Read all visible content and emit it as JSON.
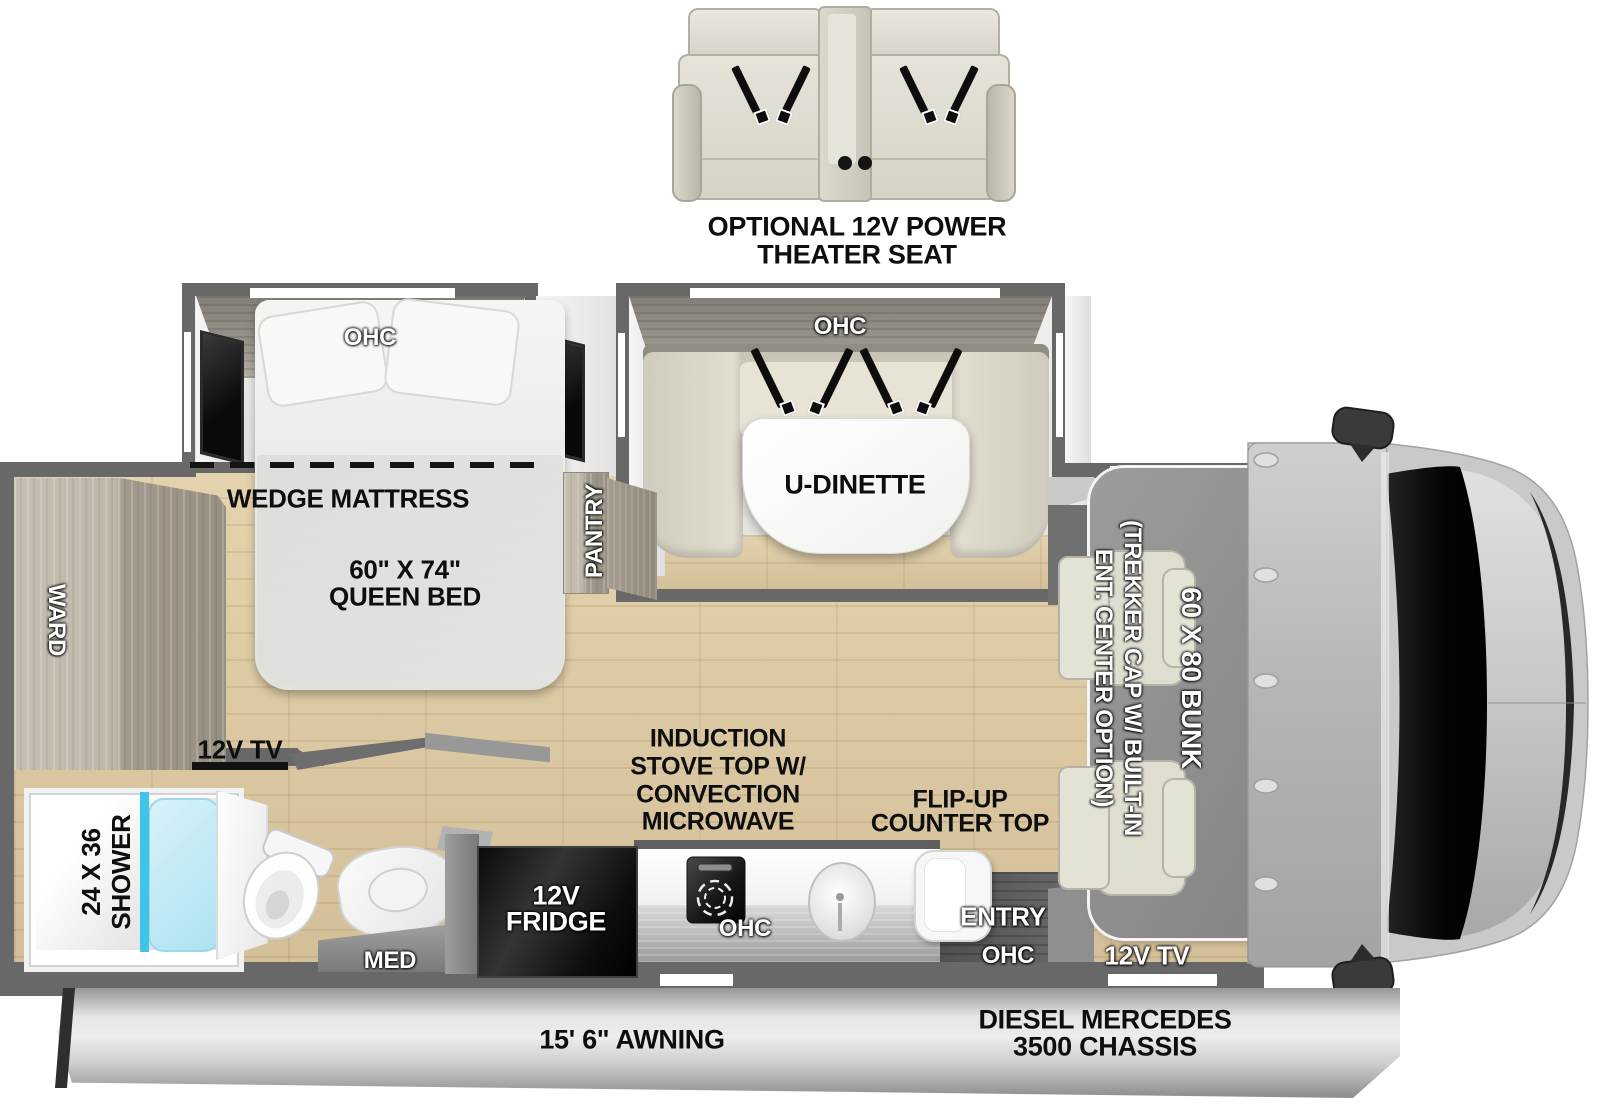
{
  "optional_feature": {
    "line1": "OPTIONAL 12V POWER",
    "line2": "THEATER SEAT"
  },
  "bedroom": {
    "ohc_label": "OHC",
    "wedge_mattress_label": "WEDGE MATTRESS",
    "queen_bed_line1": "60\" X 74\"",
    "queen_bed_line2": "QUEEN BED",
    "tv_label": "12V TV",
    "wardrobe_label": "WARD",
    "pantry_label": "PANTRY"
  },
  "bathroom": {
    "shower_line1": "24 X 36",
    "shower_line2": "SHOWER",
    "med_label": "MED"
  },
  "kitchen": {
    "fridge_line1": "12V",
    "fridge_line2": "FRIDGE",
    "induction_line1": "INDUCTION",
    "induction_line2": "STOVE TOP W/",
    "induction_line3": "CONVECTION",
    "induction_line4": "MICROWAVE",
    "ohc_label": "OHC",
    "flipup_line1": "FLIP-UP",
    "flipup_line2": "COUNTER TOP"
  },
  "dinette": {
    "ohc_label": "OHC",
    "table_label": "U-DINETTE"
  },
  "entry": {
    "entry_label": "ENTRY",
    "ohc_label": "OHC"
  },
  "cab": {
    "bunk_label": "60 X 80 BUNK",
    "trekker_line1": "(TREKKER CAP W/ BUILT-IN",
    "trekker_line2": "ENT. CENTER OPTION)",
    "tv_label": "12V TV"
  },
  "chassis": {
    "line1": "DIESEL MERCEDES",
    "line2": "3500 CHASSIS"
  },
  "awning_label": "15' 6\" AWNING",
  "colors": {
    "wall": "#686868",
    "floor": "#d9c9a6",
    "shower_glass": "#3dc4e6",
    "cab_body": "#c9c9c9",
    "windshield": "#0c0c0c",
    "seat_beige": "#dcd8ca",
    "bunk_overlay": "#8f8f8f"
  }
}
